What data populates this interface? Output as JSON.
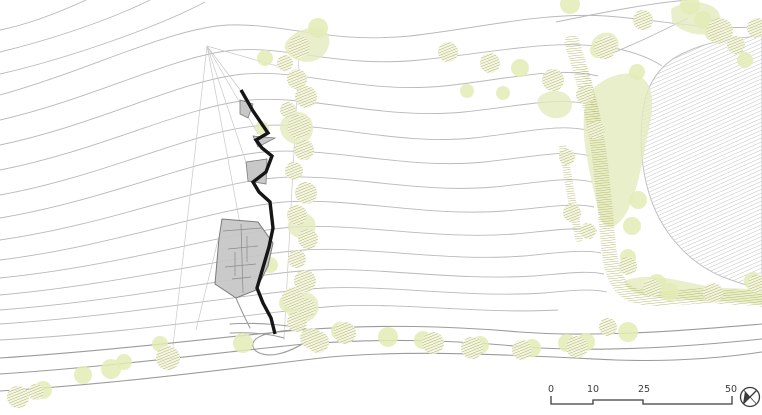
{
  "plan": {
    "width": 762,
    "height": 415,
    "colors": {
      "background": "#ffffff",
      "contour": "#b9b9b9",
      "survey": "#c9c9c9",
      "road": "#9b9b9b",
      "water_line": "#c2c2c2",
      "water_hatch": "#a9a9a9",
      "canopy": "#e4ebbd",
      "soft_tree": "#e3ecb6",
      "tree_bg": "#f4f5e2",
      "tree_hatch": "#a6ab58",
      "hedge": "#a9ae55",
      "building_fill": "#c5c5c5",
      "building_line": "#7a7a7a",
      "wall": "#161616",
      "text": "#3c3c3c"
    },
    "contours": [
      "M86,0 C60,12 30,24 0,30",
      "M150,0 C110,20 50,40 0,52",
      "M205,2 C160,26 70,58 0,74",
      "M0,95 C90,70 170,28 228,25 C285,23 330,44 410,36 C480,28 542,12 606,16 C662,20 712,32 762,26",
      "M0,120 C95,98 175,55 235,50 C290,46 340,68 420,60 C492,53 552,38 614,48 C634,52 650,58 662,66",
      "M0,145 C100,124 180,80 244,74 C302,69 364,94 444,86 C510,79 556,66 598,76",
      "M0,170 C102,150 185,106 250,100 C310,95 384,120 464,112 C522,106 558,96 592,105",
      "M0,195 C105,176 190,132 256,126 C322,120 394,146 474,138 C527,132 562,123 590,131",
      "M0,218 C108,200 196,158 264,152 C330,146 404,170 484,162 C533,157 566,149 590,156",
      "M0,240 C112,224 204,184 274,178 C340,172 414,194 494,187 C537,183 569,176 592,182",
      "M0,260 C114,246 214,208 284,202 C350,197 424,217 504,211 C543,208 573,202 594,207",
      "M0,278 C122,266 224,232 294,227 C360,223 434,240 514,234 C549,231 577,226 597,231",
      "M0,295 C124,284 234,255 304,250 C370,246 444,262 524,256 C555,253 583,249 601,253",
      "M0,310 C132,300 244,274 314,270 C380,267 454,281 534,276 C561,274 587,270 604,274",
      "M0,324 C134,315 254,292 324,288 C392,285 464,298 544,293 C567,291 591,288 607,292",
      "M0,340 C150,332 270,310 340,306 C410,303 480,314 558,310",
      "M556,22 C600,13 650,3 688,0",
      "M600,58 C636,44 664,30 688,18"
    ],
    "survey_lines": [
      "M207,46 L173,346",
      "M207,46 L241,91",
      "M207,46 L258,134",
      "M207,46 L252,180",
      "M207,46 L240,224",
      "M207,46 L284,68",
      "M300,36 L284,340",
      "M218,240 L196,330"
    ],
    "roads": [
      "M0,358 C120,350 230,336 300,330 C380,324 450,326 520,332 C600,338 690,330 762,324",
      "M0,374 C120,366 230,351 305,344 C385,338 455,340 525,347 C605,353 695,346 762,339",
      "M0,391 C130,383 250,366 330,357 C420,349 530,356 615,360 C675,362 722,358 762,352",
      "M230,324 C258,322 288,325 312,330",
      "M230,333 C252,332 270,334 284,338",
      "M312,330 C286,329 256,333 253,343 C251,352 264,357 278,354 C292,351 303,344 311,338",
      "M236,298 C241,310 246,320 250,328"
    ],
    "water_outline": "M762,36 C728,38 702,44 686,52 C664,61 650,79 645,100 C640,122 640,150 644,172 C648,196 656,216 669,234 C683,253 701,268 723,277 C741,284 753,287 762,288 Z",
    "canopies": [
      "M588,96 C598,78 626,68 641,77 C656,86 653,112 648,133 C643,158 639,186 628,210 C618,229 604,235 599,214 C594,190 586,160 584,136 C583,118 584,107 588,96 Z",
      "M539,97 C549,88 566,89 571,100 C575,110 566,120 553,118 C542,116 534,105 539,97 Z",
      "M671,9 C684,0 706,0 716,9 C723,15 721,28 710,33 C697,38 679,30 672,22 Z",
      "M624,281 C650,271 682,282 707,286 C732,290 752,287 762,291 L762,305 C740,301 700,301 670,299 C647,297 628,295 624,281 Z",
      "M286,42 C296,28 318,23 327,33 C333,42 327,57 314,61 C299,65 280,54 286,42 Z",
      "M282,120 C292,108 308,110 312,122 C316,134 308,146 295,144 C284,142 276,130 282,120 Z",
      "M288,300 C298,288 314,290 318,302 C321,313 312,324 300,322 C289,320 282,310 288,300 Z",
      "M290,220 C298,210 312,212 315,222 C318,232 310,240 299,238 C290,236 284,228 290,220 Z",
      "M593,40 C600,30 614,30 618,40 C621,49 613,57 603,55 C595,53 589,47 593,40 Z"
    ],
    "hedges": [
      [
        "M572,42 C580,70 591,102 597,140 C603,176 605,212 609,250 C612,274 618,289 633,295 C661,303 693,294 717,296 C738,298 752,297 762,299",
        15
      ],
      [
        "M563,148 C568,178 573,208 579,238",
        8
      ],
      [
        "M585,70 C590,88 594,104 597,118",
        7
      ]
    ],
    "soft_trees": [
      [
        265,
        58,
        8
      ],
      [
        318,
        28,
        10
      ],
      [
        262,
        128,
        7
      ],
      [
        270,
        265,
        8
      ],
      [
        520,
        68,
        9
      ],
      [
        503,
        93,
        7
      ],
      [
        467,
        91,
        7
      ],
      [
        570,
        4,
        10
      ],
      [
        598,
        50,
        8
      ],
      [
        637,
        72,
        8
      ],
      [
        690,
        5,
        10
      ],
      [
        703,
        20,
        9
      ],
      [
        713,
        33,
        8
      ],
      [
        745,
        60,
        8
      ],
      [
        638,
        200,
        9
      ],
      [
        632,
        226,
        9
      ],
      [
        628,
        257,
        8
      ],
      [
        43,
        390,
        9
      ],
      [
        83,
        375,
        9
      ],
      [
        111,
        369,
        10
      ],
      [
        124,
        362,
        8
      ],
      [
        160,
        344,
        8
      ],
      [
        243,
        343,
        10
      ],
      [
        288,
        303,
        9
      ],
      [
        312,
        337,
        9
      ],
      [
        340,
        331,
        9
      ],
      [
        388,
        337,
        10
      ],
      [
        423,
        340,
        9
      ],
      [
        480,
        345,
        9
      ],
      [
        532,
        348,
        9
      ],
      [
        567,
        343,
        9
      ],
      [
        586,
        342,
        9
      ],
      [
        628,
        332,
        10
      ],
      [
        657,
        283,
        9
      ],
      [
        670,
        292,
        9
      ],
      [
        753,
        281,
        9
      ]
    ],
    "hatched_trees": [
      [
        299,
        47,
        11
      ],
      [
        285,
        63,
        8
      ],
      [
        297,
        79,
        10
      ],
      [
        306,
        97,
        11
      ],
      [
        288,
        110,
        8
      ],
      [
        299,
        127,
        12
      ],
      [
        304,
        150,
        10
      ],
      [
        294,
        171,
        9
      ],
      [
        306,
        193,
        11
      ],
      [
        297,
        215,
        10
      ],
      [
        308,
        239,
        10
      ],
      [
        297,
        259,
        9
      ],
      [
        305,
        281,
        11
      ],
      [
        293,
        298,
        11
      ],
      [
        307,
        308,
        9
      ],
      [
        297,
        322,
        10
      ],
      [
        310,
        338,
        10
      ],
      [
        448,
        52,
        10
      ],
      [
        490,
        63,
        10
      ],
      [
        553,
        80,
        11
      ],
      [
        605,
        48,
        11
      ],
      [
        643,
        20,
        10
      ],
      [
        608,
        45,
        9
      ],
      [
        720,
        31,
        13
      ],
      [
        736,
        45,
        9
      ],
      [
        757,
        28,
        10
      ],
      [
        585,
        95,
        9
      ],
      [
        596,
        130,
        9
      ],
      [
        567,
        157,
        8
      ],
      [
        572,
        213,
        9
      ],
      [
        588,
        231,
        8
      ],
      [
        628,
        266,
        9
      ],
      [
        652,
        288,
        9
      ],
      [
        713,
        293,
        10
      ],
      [
        757,
        284,
        9
      ],
      [
        18,
        397,
        11
      ],
      [
        36,
        392,
        8
      ],
      [
        168,
        358,
        12
      ],
      [
        318,
        342,
        11
      ],
      [
        345,
        333,
        11
      ],
      [
        433,
        343,
        11
      ],
      [
        472,
        348,
        11
      ],
      [
        522,
        350,
        10
      ],
      [
        577,
        347,
        11
      ],
      [
        608,
        327,
        9
      ]
    ],
    "terraces": [
      "240,100 253,104 248,118 240,114",
      "253,136 275,138 258,147",
      "246,162 267,159 266,184 248,181"
    ],
    "building": {
      "outline": "222,219 258,222 273,243 268,266 256,290 236,298 215,284 219,238",
      "inner_lines": [
        "M223,231 L262,228",
        "M241,224 L243,293",
        "M228,249 L258,246",
        "M225,267 L256,264",
        "M232,279 L251,277",
        "M247,236 L247,262",
        "M235,252 L235,276"
      ]
    },
    "wall_path": "M241,90 L253,111 L268,133 L256,140 L262,148 L272,156 L266,172 L253,182 L259,192 L270,202 L273,228 L269,247 L257,288 L263,303 L271,318 L275,334",
    "scale_bar": {
      "bar_path": "M551,396 L551,404 L593,404 L593,400 L643,400 L643,404 L732,404 L732,396",
      "labels": [
        {
          "text": "0",
          "x": 548
        },
        {
          "text": "10",
          "x": 587
        },
        {
          "text": "25",
          "x": 638
        },
        {
          "text": "50",
          "x": 725
        }
      ],
      "label_y": 392
    },
    "compass": {
      "cx": 750,
      "cy": 397,
      "r": 9.5
    }
  }
}
